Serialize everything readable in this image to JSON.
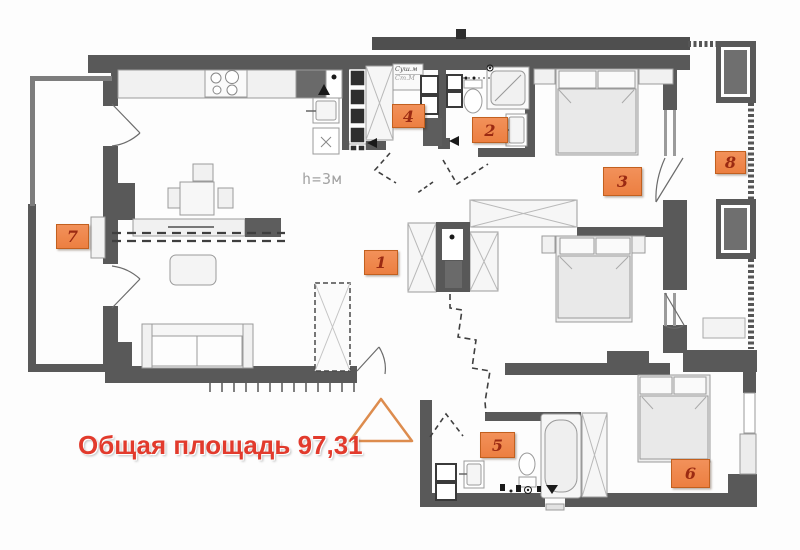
{
  "plan": {
    "area_note": "Общая площадь 97,31",
    "height_note": "h=3м",
    "appliances": {
      "dryer": "Суш.м",
      "washer": "Ст.М"
    },
    "room_labels": [
      {
        "room": "kitchen-living-room",
        "number": "1"
      },
      {
        "room": "bathroom-upper",
        "number": "2"
      },
      {
        "room": "bedroom-upper",
        "number": "3"
      },
      {
        "room": "laundry",
        "number": "4"
      },
      {
        "room": "bathroom-lower",
        "number": "5"
      },
      {
        "room": "bedroom-lower",
        "number": "6"
      },
      {
        "room": "loggia-left",
        "number": "7"
      },
      {
        "room": "balcony-right",
        "number": "8"
      }
    ],
    "colors": {
      "wall": "#595959",
      "wall_light": "#7d7d7d",
      "label_bg": "#ef8449",
      "label_border": "#c2601f",
      "label_text": "#9b2a12",
      "area_text": "#e23a2c",
      "triangle": "#dd8c4e"
    }
  }
}
